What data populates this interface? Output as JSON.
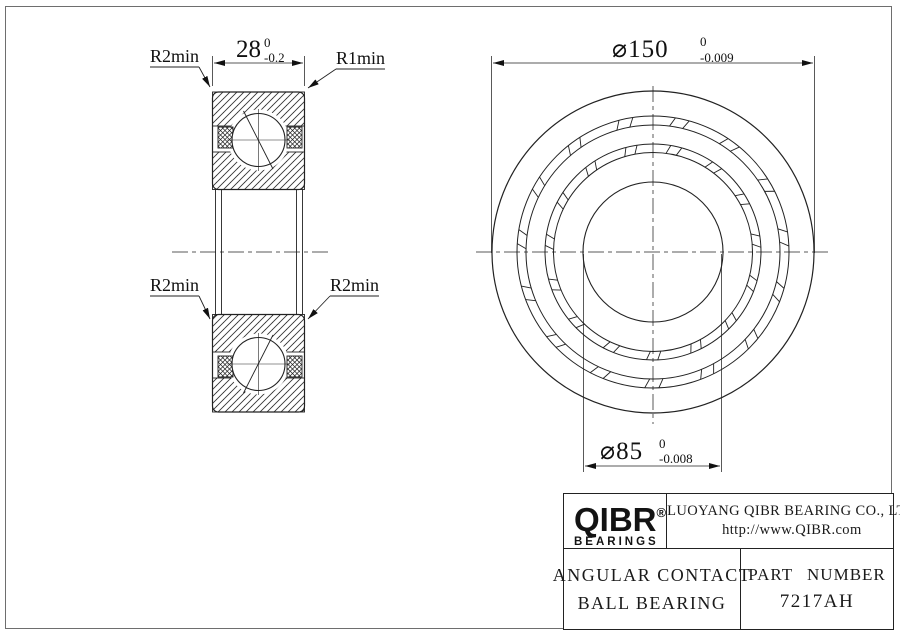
{
  "drawing": {
    "left_view": {
      "width_dim": {
        "value": "28",
        "tol_upper": "0",
        "tol_lower": "-0.2"
      },
      "label_top_left": "R2min",
      "label_top_right": "R1min",
      "label_mid_left": "R2min",
      "label_mid_right": "R2min"
    },
    "front_view": {
      "od_dim": {
        "symbol": "⌀",
        "value": "150",
        "tol_upper": "0",
        "tol_lower": "-0.009"
      },
      "bore_dim": {
        "symbol": "⌀",
        "value": "85",
        "tol_upper": "0",
        "tol_lower": "-0.008"
      }
    }
  },
  "title_block": {
    "logo_text": "QIBR",
    "logo_registered": "®",
    "logo_sub": "BEARINGS",
    "company_name": "LUOYANG QIBR BEARING CO., LTD",
    "website": "http://www.QIBR.com",
    "product_line1": "ANGULAR CONTACT",
    "product_line2": "BALL BEARING",
    "part_number_label": "PART NUMBER",
    "part_number": "7217AH"
  }
}
